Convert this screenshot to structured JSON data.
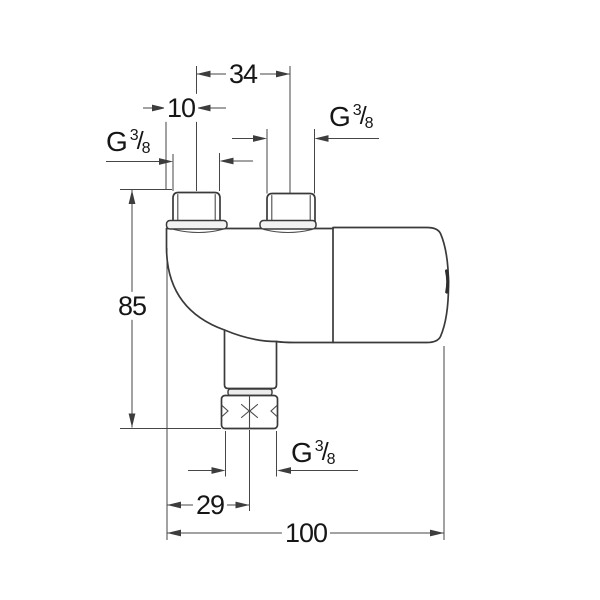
{
  "dimensions": {
    "inlet_spacing_mm": "34",
    "inlet_center_offset_mm": "10",
    "overall_height_mm": "85",
    "outlet_center_offset_mm": "29",
    "overall_width_mm": "100"
  },
  "thread_label": {
    "prefix": "G",
    "numerator": "3",
    "slash": "/",
    "denominator": "8"
  },
  "colors": {
    "background": "#ffffff",
    "part_outline": "#3a3a3a",
    "dimension_lines": "#464646",
    "text": "#161616"
  }
}
